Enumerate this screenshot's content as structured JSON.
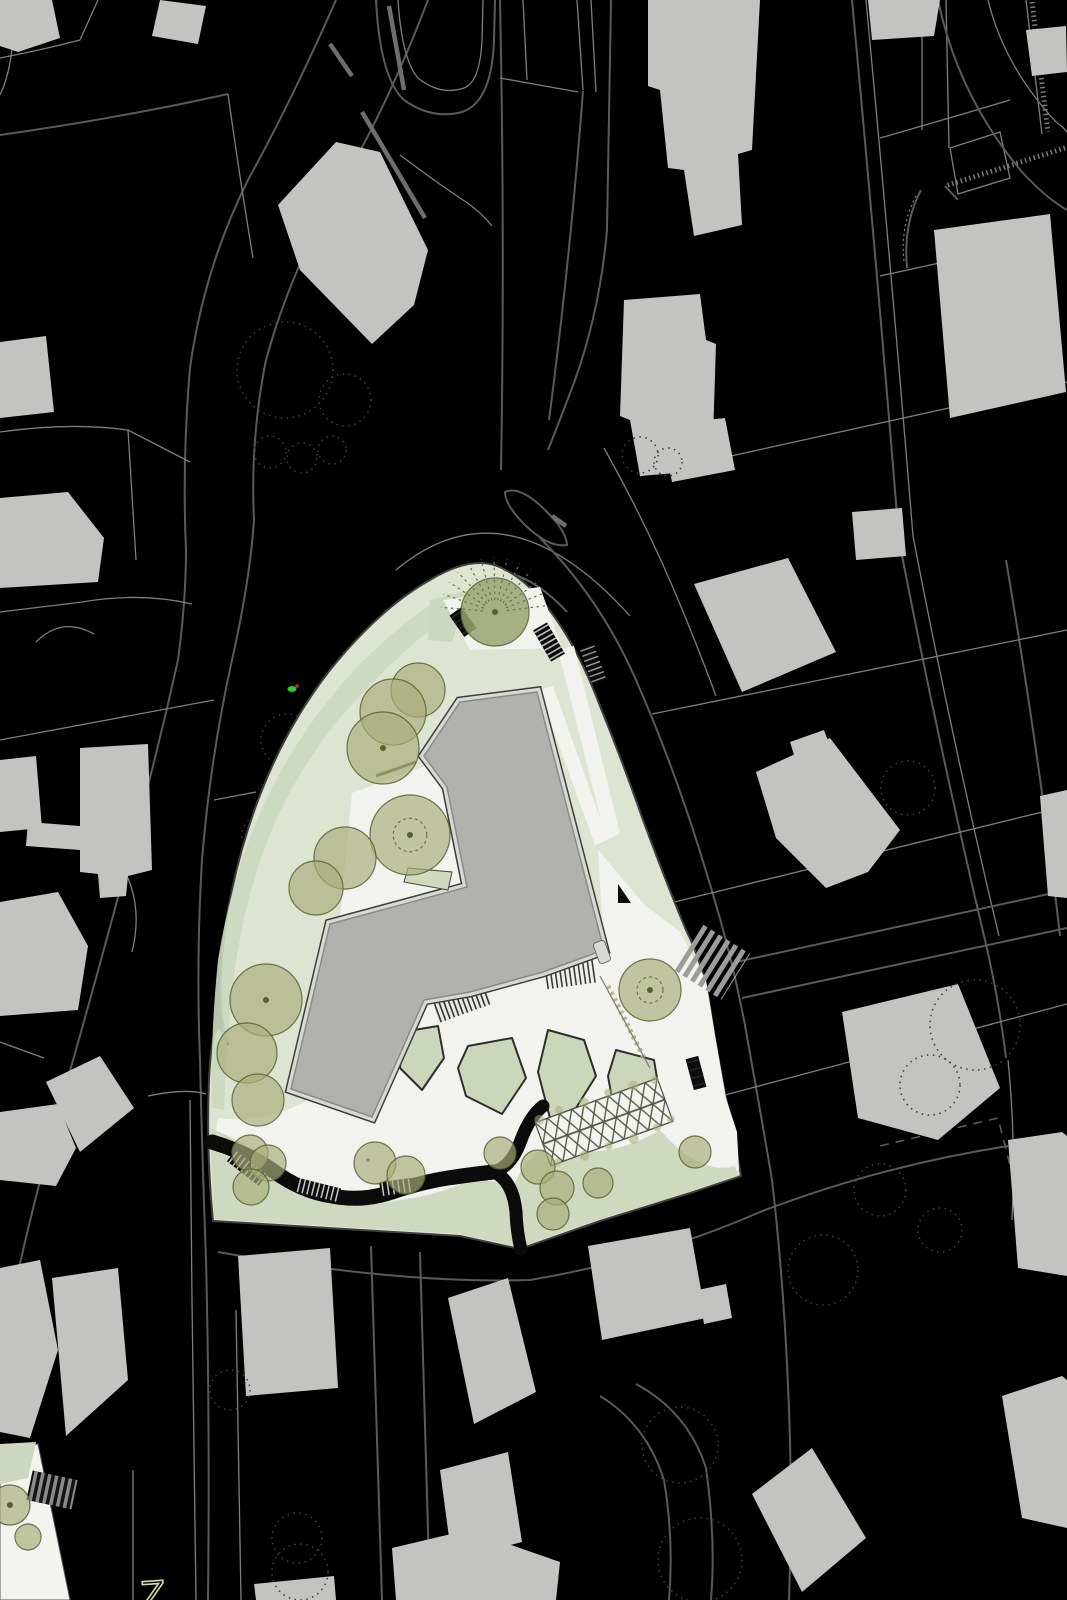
{
  "meta": {
    "type": "architectural-site-plan",
    "description": "Black figure-ground site plan with a landscaped triangular parcel, building footprint, trees, pergola and surrounding urban fabric"
  },
  "palette": {
    "background": "#000000",
    "parcel_line": "#5a5a5a",
    "parcel_line_light": "#7e7e7e",
    "context_building": "#c3c3c1",
    "dotted_tree": "#3f3f3f",
    "site_green": "#dde4d2",
    "site_green_dark": "#ccd7bf",
    "lawn": "#cfd9c0",
    "island_green": "#cbd6ba",
    "plaza": "#f2f2ef",
    "building_fill": "#b1b1ae",
    "building_band": "#d9d9d4",
    "building_edge": "#3e3e3c",
    "path_black": "#0b0b0b",
    "tree_olive": "#a9ae7c",
    "tree_olive_dark": "#9aa472",
    "marker_green": "#2ecc2e",
    "marker_red": "#cf3333",
    "marker_blue": "#4040e0",
    "glyph_yellow": "#dcdda2",
    "zebra_gray": "#9c9c9c"
  },
  "labels": {
    "street_glyph": "Z"
  },
  "north_arrow": {
    "points": "618,884 631,903 618,903"
  },
  "markers": {
    "green": {
      "x": 292,
      "y": 689
    },
    "red": {
      "x": 297,
      "y": 686
    },
    "blue": {
      "x": 368,
      "y": 1160
    }
  },
  "site": {
    "boundary_d": "M497 566 Q522 576 543 602 Q575 640 600 706 Q622 760 643 820 Q666 882 686 930 Q702 962 709 1000 Q718 1060 728 1108 Q736 1148 741 1176 L690 1193 L600 1221 L520 1249 L460 1236 L213 1221 Q206 1150 209 1080 Q213 1000 228 1045 Q213 1000 228 910 Q240 845 262 790 Q288 724 330 670 Q380 608 430 580 Q470 556 497 566 Z",
    "west_band_d": "M452 612 Q400 652 352 704 Q300 762 270 834 Q244 900 234 975 Q226 1048 224 1110 L212 1108 Q210 1040 218 960 Q232 872 266 800 Q302 726 356 668 Q404 620 444 596 Z",
    "apex_wedge_points": "430,600 468,590 452,642 428,640",
    "top_pocket_points": "443,600 540,587 562,648 470,650",
    "west_pocket_points": "352,793 446,758 466,884 340,917",
    "ne_path_inner_points": "539,690 553,686 608,840 595,845",
    "ne_path_outer_points": "558,650 574,646 620,834 606,840",
    "plaza_d": "M598 850 L645 905 L680 932 L706 980 L715 1035 L726 1098 L737 1132 L739 1170 L700 1178 Q660 1135 618 1157 Q585 1170 560 1150 Q535 1142 517 1186 L500 1182 Q470 1178 445 1190 Q400 1204 362 1200 Q315 1194 282 1172 Q252 1148 215 1136 L218 1118 Q262 1124 304 1102 L332 1090 L372 1117 L424 1000 L470 992 L543 972 L604 950 Z",
    "lawn_d": "M210 1128 Q250 1144 284 1172 Q330 1198 378 1204 Q428 1198 462 1184 Q492 1176 512 1188 Q535 1140 560 1148 Q610 1160 660 1130 Q700 1176 735 1166 L738 1176 L690 1192 L600 1219 L520 1247 L460 1234 L214 1219 Z",
    "building_points": "460,702 537,692 604,950 543,972 470,992 424,1000 372,1117 291,1089 330,924 467,887 447,787 424,756",
    "entry_canopy_points": "408,868 452,872 448,890 404,882",
    "islands": [
      "468,1046 512,1038 526,1078 502,1114 466,1096 458,1068",
      "548,1030 584,1040 596,1076 576,1108 550,1118 538,1072",
      "616,1050 654,1060 660,1096 640,1124 614,1110 608,1076",
      "402,1032 438,1026 444,1058 422,1090 400,1068"
    ],
    "path_main_d": "M212 1142 Q246 1152 272 1170 Q302 1192 332 1196 Q362 1202 392 1192 Q422 1182 448 1178 Q475 1174 494 1172",
    "path_branch_up_d": "M494 1172 Q512 1166 521 1140 Q530 1116 543 1106",
    "path_branch_down_d": "M494 1172 Q513 1181 516 1212 Q517 1234 521 1249",
    "trees": [
      {
        "x": 495,
        "y": 612,
        "r": 34,
        "v": "radial"
      },
      {
        "x": 418,
        "y": 690,
        "r": 27,
        "v": "canopy"
      },
      {
        "x": 393,
        "y": 712,
        "r": 33,
        "v": "canopy"
      },
      {
        "x": 383,
        "y": 748,
        "r": 36,
        "v": "dot"
      },
      {
        "x": 410,
        "y": 835,
        "r": 40,
        "v": "ring"
      },
      {
        "x": 345,
        "y": 858,
        "r": 31,
        "v": "canopy"
      },
      {
        "x": 316,
        "y": 888,
        "r": 27,
        "v": "canopy"
      },
      {
        "x": 266,
        "y": 1000,
        "r": 36,
        "v": "dot"
      },
      {
        "x": 247,
        "y": 1053,
        "r": 30,
        "v": "canopy"
      },
      {
        "x": 258,
        "y": 1100,
        "r": 26,
        "v": "canopy"
      },
      {
        "x": 250,
        "y": 1153,
        "r": 18,
        "v": "canopy"
      },
      {
        "x": 268,
        "y": 1163,
        "r": 18,
        "v": "canopy"
      },
      {
        "x": 251,
        "y": 1187,
        "r": 18,
        "v": "canopy"
      },
      {
        "x": 375,
        "y": 1163,
        "r": 21,
        "v": "canopy"
      },
      {
        "x": 406,
        "y": 1175,
        "r": 19,
        "v": "canopy"
      },
      {
        "x": 500,
        "y": 1153,
        "r": 16,
        "v": "canopy"
      },
      {
        "x": 538,
        "y": 1167,
        "r": 17,
        "v": "canopy"
      },
      {
        "x": 557,
        "y": 1188,
        "r": 17,
        "v": "canopy"
      },
      {
        "x": 598,
        "y": 1183,
        "r": 15,
        "v": "canopy"
      },
      {
        "x": 553,
        "y": 1214,
        "r": 16,
        "v": "canopy"
      },
      {
        "x": 650,
        "y": 990,
        "r": 31,
        "v": "ring"
      },
      {
        "x": 695,
        "y": 1152,
        "r": 16,
        "v": "canopy"
      },
      {
        "x": 10,
        "y": 1505,
        "r": 20,
        "v": "dot"
      },
      {
        "x": 28,
        "y": 1537,
        "r": 13,
        "v": "canopy"
      }
    ]
  },
  "context": {
    "buildings": [
      "0,0 52,0 60,38 18,52 0,46",
      "160,0 206,6 198,44 152,36",
      "278,205 336,142 380,152 428,250 414,305 372,344 300,270",
      "648,0 760,0 752,150 738,154 742,225 694,236 684,170 668,168 660,90 648,86",
      "868,0 940,0 934,36 872,40",
      "1026,30 1066,26 1067,72 1032,76",
      "934,230 1050,214 1066,392 950,418",
      "624,300 700,294 706,340 716,344 712,470 640,476 630,420 620,416",
      "852,512 902,508 906,556 856,560",
      "694,584 788,558 836,652 742,692",
      "790,742 824,730 836,762 800,774",
      "756,772 830,738 900,830 868,872 826,888 776,838",
      "842,1012 958,984 1000,1088 938,1140 858,1118",
      "1040,796 1067,790 1067,898 1048,896",
      "1008,1140 1062,1132 1067,1136 1067,1276 1018,1268",
      "1002,1396 1062,1376 1067,1380 1067,1528 1022,1518",
      "752,1494 812,1448 866,1538 802,1592",
      "588,1246 690,1228 706,1318 602,1340",
      "698,1290 726,1284 732,1318 704,1324",
      "440,1470 508,1452 522,1542 452,1560",
      "392,1548 468,1530 560,1562 556,1600 396,1600",
      "254,1584 334,1576 336,1600 256,1600",
      "0,1268 40,1260 58,1350 30,1438 0,1432",
      "52,1278 118,1268 128,1380 66,1436",
      "0,1112 58,1104 76,1148 56,1186 0,1180",
      "238,1256 330,1248 338,1388 246,1396",
      "448,1298 508,1278 536,1392 474,1424",
      "80,748 148,744 152,870 128,876 126,896 100,898 98,874 80,872",
      "28,822 80,826 80,850 26,846",
      "0,342 46,336 54,412 0,418",
      "0,498 68,492 104,538 98,582 0,588",
      "0,760 36,756 42,828 0,832",
      "0,902 58,892 88,946 78,1010 0,1016",
      "46,1082 100,1056 134,1108 80,1152",
      "660,425 725,418 735,470 672,482"
    ],
    "dotted_trees": [
      [
        285,
        370,
        48
      ],
      [
        345,
        400,
        26
      ],
      [
        270,
        452,
        16
      ],
      [
        302,
        458,
        15
      ],
      [
        332,
        450,
        14
      ],
      [
        287,
        740,
        26
      ],
      [
        310,
        790,
        22
      ],
      [
        262,
        835,
        20
      ],
      [
        908,
        788,
        27
      ],
      [
        975,
        1025,
        45
      ],
      [
        930,
        1085,
        30
      ],
      [
        823,
        1270,
        35
      ],
      [
        640,
        455,
        18
      ],
      [
        668,
        462,
        14
      ],
      [
        300,
        1572,
        28
      ],
      [
        700,
        1560,
        42
      ],
      [
        297,
        1538,
        25
      ],
      [
        680,
        1445,
        38
      ],
      [
        230,
        1390,
        20
      ],
      [
        880,
        1190,
        26
      ],
      [
        940,
        1230,
        22
      ],
      [
        640,
        1120,
        30
      ]
    ]
  }
}
